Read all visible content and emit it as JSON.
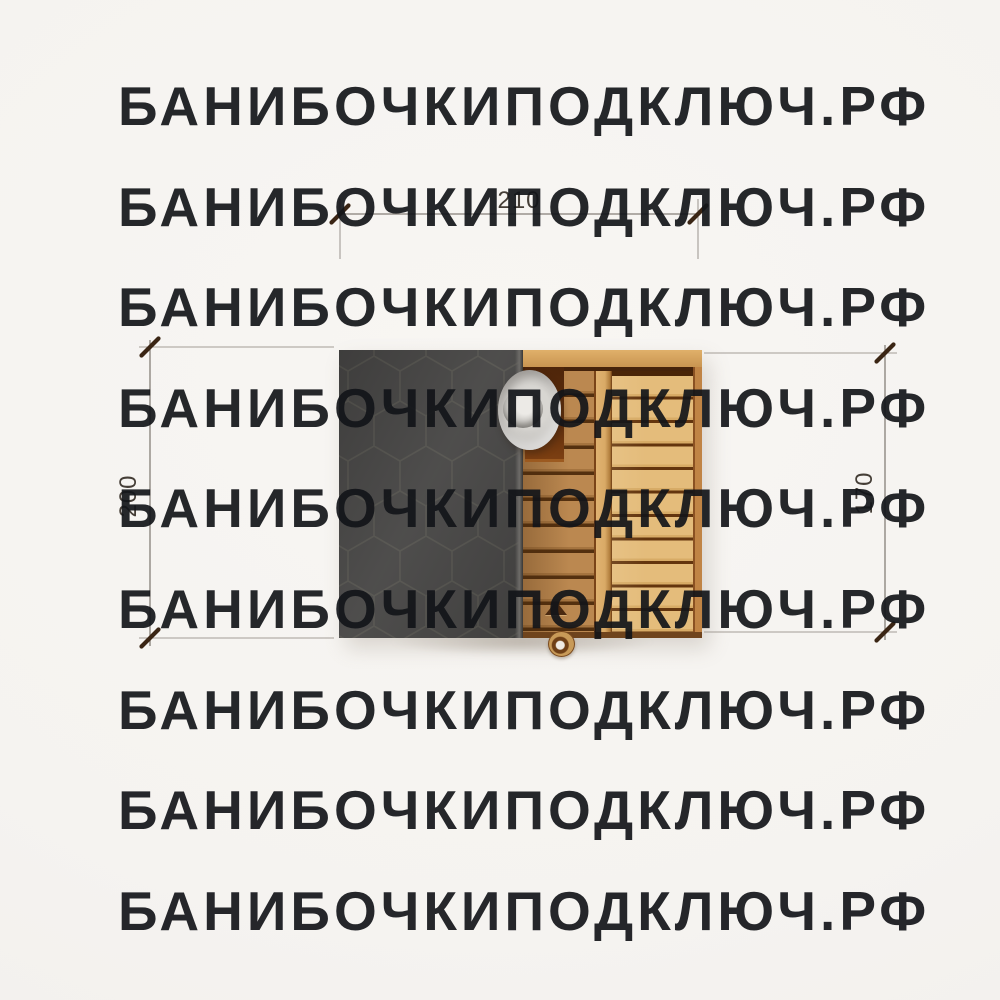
{
  "watermark": {
    "text": "БАНИБОЧКИПОДКЛЮЧ.РФ",
    "row_count": 9,
    "color": "#e3e0dc"
  },
  "dimensions": {
    "width_top": "210",
    "height_left": "200",
    "height_right": "170",
    "unit_note": ""
  },
  "drawing": {
    "subject": "barrel-sauna-top-view-plan",
    "parts": {
      "roof": "hexagonal-shingle-roof",
      "deck": "wooden-plank-deck",
      "chimney": "round-chimney-cap",
      "handle": "door-handle-knob",
      "vent": "triangle-vent-marker"
    }
  },
  "colors": {
    "background": "#f5f3f0",
    "roof": "#454443",
    "roof_hex_line": "#57554f",
    "wood_left": "#bb8850",
    "wood_right": "#e4bc7b",
    "wood_gap": "#5c3310",
    "chimney_housing": "#63300d",
    "chimney_cap": "#cfcdc9",
    "dimension_line": "#857f78",
    "dimension_tick": "#3a2514",
    "dimension_text": "#453e37"
  }
}
